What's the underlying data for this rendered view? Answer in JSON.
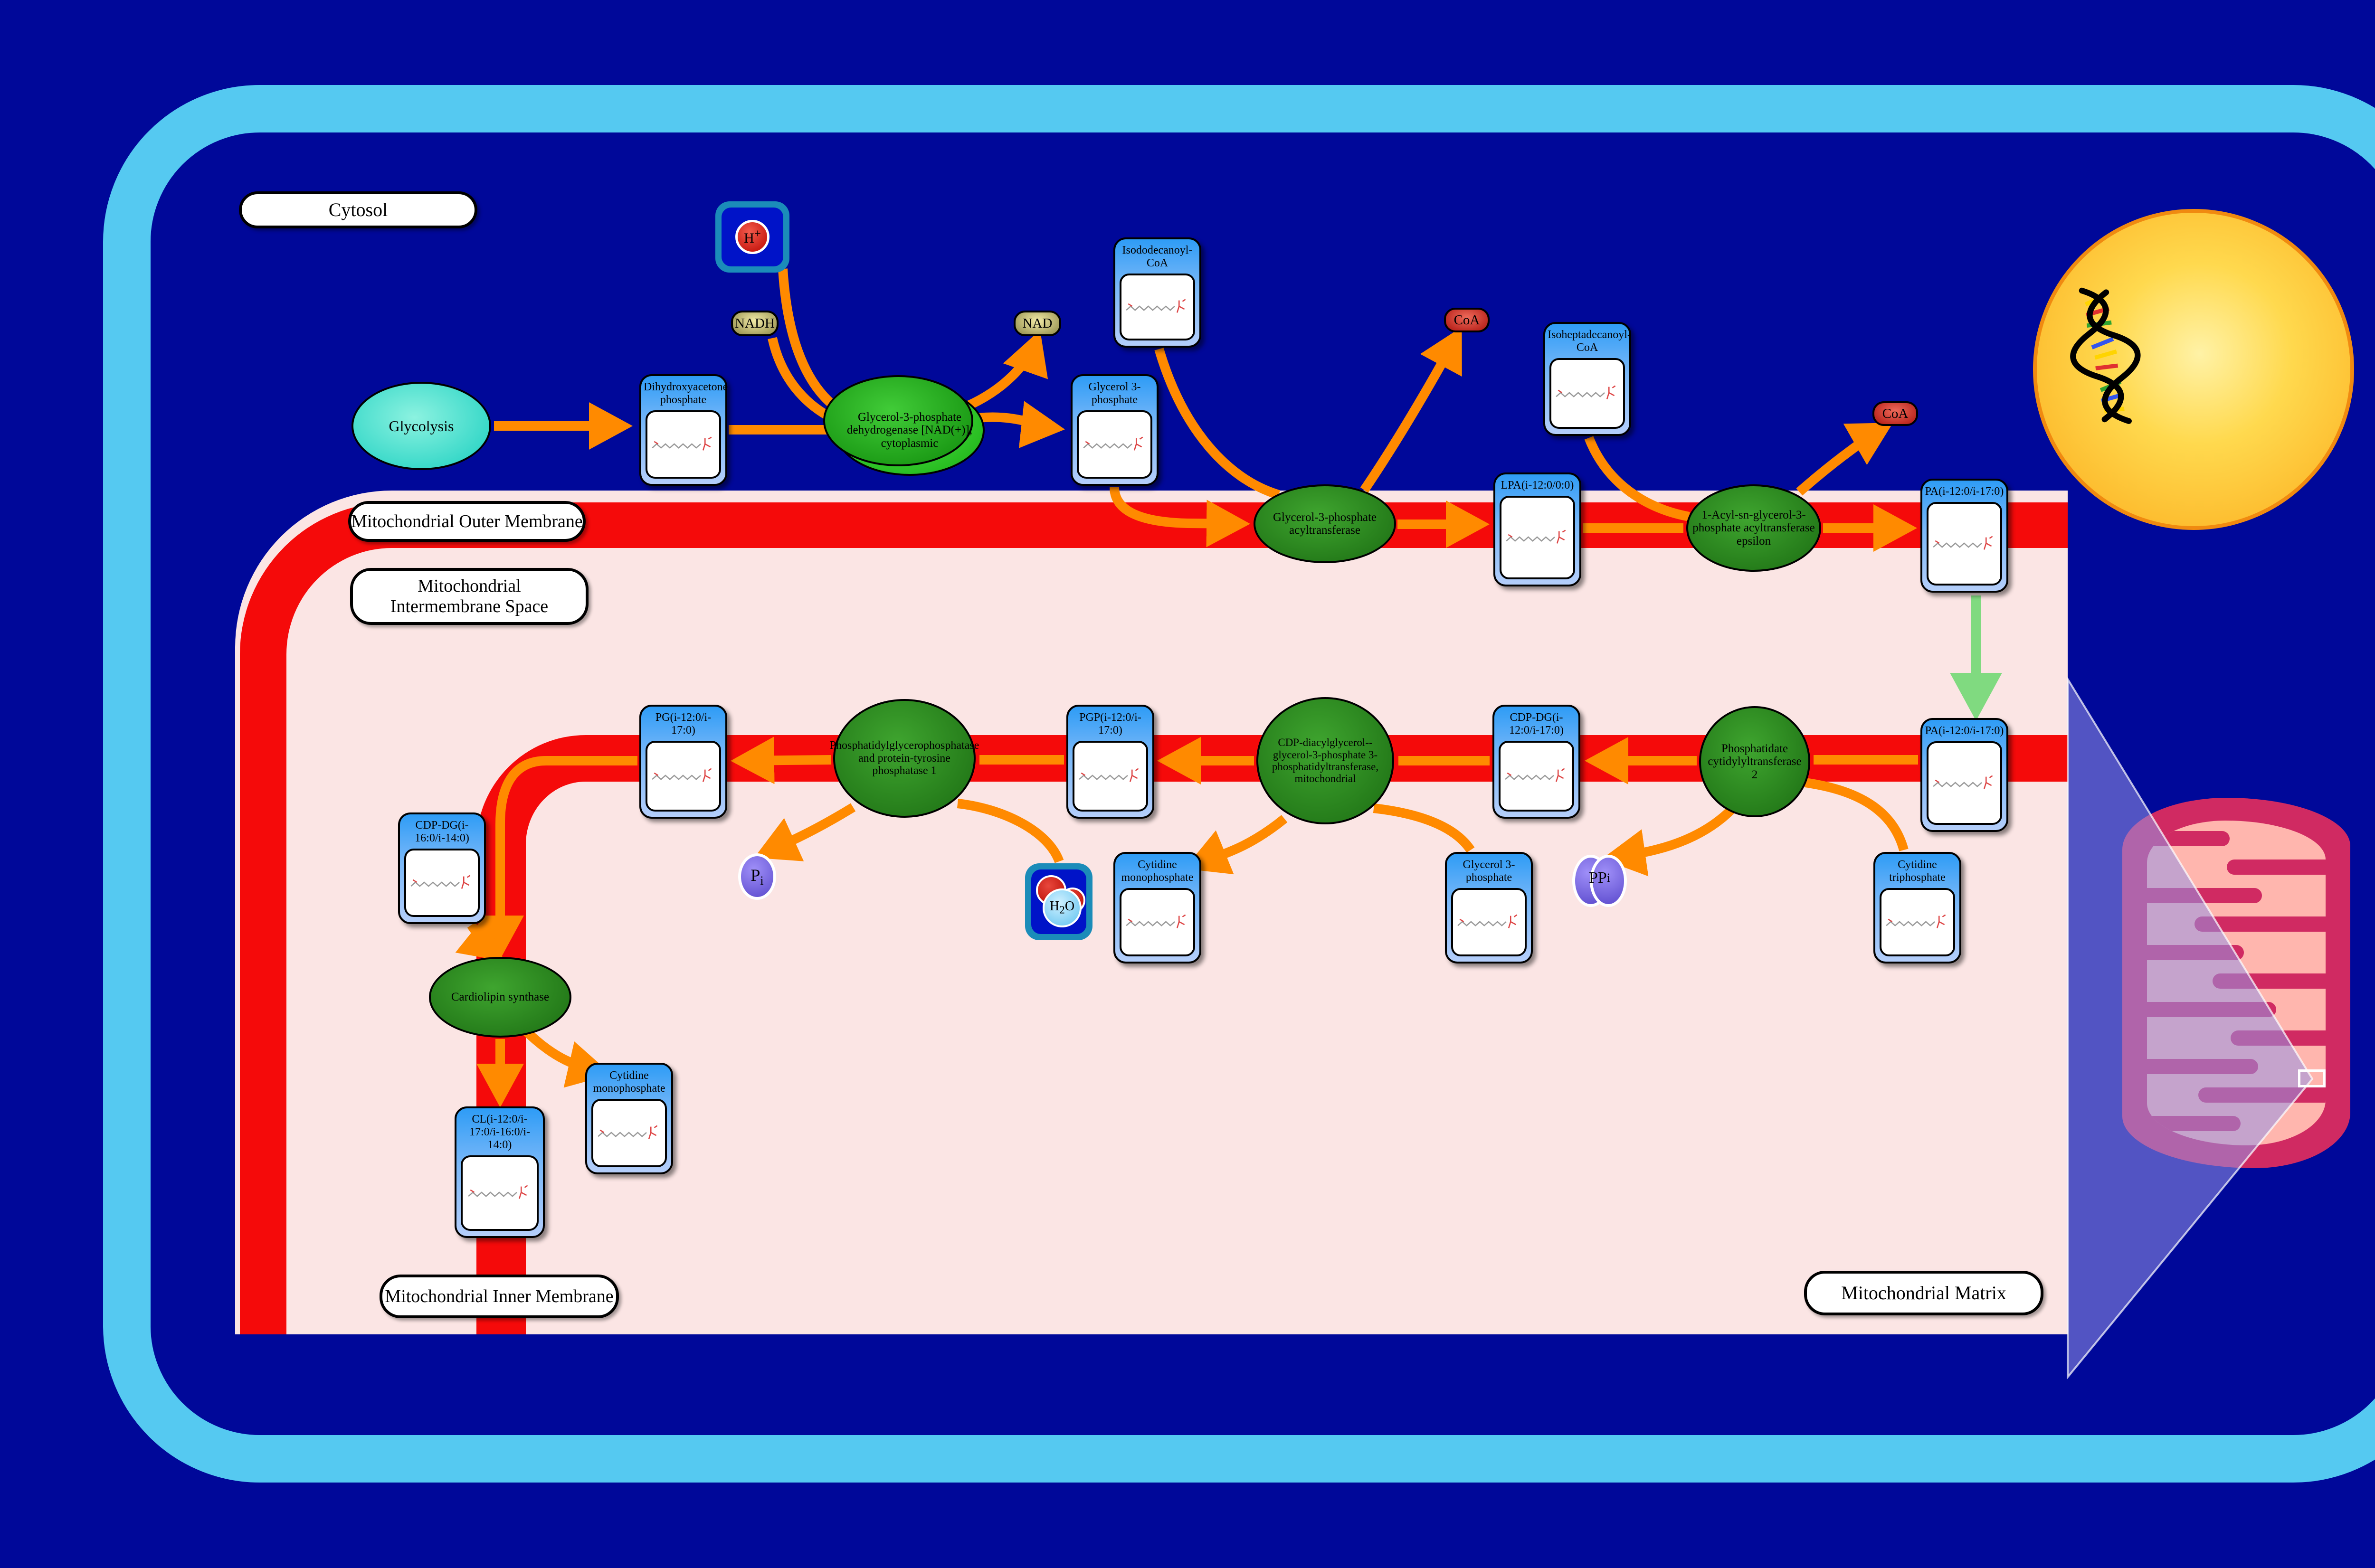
{
  "regions": {
    "cytosol": "Cytosol",
    "outer_membrane": "Mitochondrial Outer Membrane",
    "intermembrane_space": "Mitochondrial Intermembrane Space",
    "inner_membrane": "Mitochondrial Inner Membrane",
    "matrix": "Mitochondrial Matrix"
  },
  "nodes": {
    "glycolysis": {
      "label": "Glycolysis",
      "type": "pathway"
    },
    "dhap": {
      "label": "Dihydroxyacetone phosphate",
      "type": "compound"
    },
    "g3pdh": {
      "label": "Glycerol-3-phosphate dehydrogenase [NAD(+)], cytoplasmic",
      "type": "enzyme"
    },
    "nadh": {
      "label": "NADH",
      "type": "cofactor"
    },
    "nad": {
      "label": "NAD",
      "type": "cofactor"
    },
    "h_ion": {
      "base": "H",
      "sup": "+",
      "type": "ion-icon"
    },
    "g3p_cytosol": {
      "label": "Glycerol 3-phosphate",
      "type": "compound"
    },
    "isododecanoyl_coa": {
      "label": "Isododecanoyl-CoA",
      "type": "compound"
    },
    "gpat": {
      "label": "Glycerol-3-phosphate acyltransferase",
      "type": "enzyme"
    },
    "coa_1": {
      "label": "CoA",
      "type": "cofactor"
    },
    "coa_2": {
      "label": "CoA",
      "type": "cofactor"
    },
    "lpa": {
      "label": "LPA(i-12:0/0:0)",
      "type": "compound"
    },
    "isoheptadecanoyl_coa": {
      "label": "Isoheptadecanoyl-CoA",
      "type": "compound"
    },
    "agpat_epsilon": {
      "label": "1-Acyl-sn-glycerol-3-phosphate acyltransferase epsilon",
      "type": "enzyme"
    },
    "pa_outer": {
      "label": "PA(i-12:0/i-17:0)",
      "type": "compound"
    },
    "pa_inner": {
      "label": "PA(i-12:0/i-17:0)",
      "type": "compound"
    },
    "pct2": {
      "label": "Phosphatidate cytidylyltransferase 2",
      "type": "enzyme"
    },
    "cdp_dg_12_17": {
      "label": "CDP-DG(i-12:0/i-17:0)",
      "type": "compound"
    },
    "cgs_transferase": {
      "label": "CDP-diacylglycerol--glycerol-3-phosphate 3-phosphatidyltransferase, mitochondrial",
      "type": "enzyme"
    },
    "pgp": {
      "label": "PGP(i-12:0/i-17:0)",
      "type": "compound"
    },
    "pgpase": {
      "label": "Phosphatidylglycerophosphatase and protein-tyrosine phosphatase 1",
      "type": "enzyme"
    },
    "pg": {
      "label": "PG(i-12:0/i-17:0)",
      "type": "compound"
    },
    "pi": {
      "base": "P",
      "sub": "i",
      "type": "ion"
    },
    "ppi": {
      "base": "PP",
      "sub": "i",
      "type": "ion"
    },
    "h2o": {
      "h": "H",
      "sub": "2",
      "o": "O",
      "type": "molecule-icon"
    },
    "cmp_1": {
      "label": "Cytidine monophosphate",
      "type": "compound"
    },
    "g3p_matrix": {
      "label": "Glycerol 3-phosphate",
      "type": "compound"
    },
    "ctp": {
      "label": "Cytidine triphosphate",
      "type": "compound"
    },
    "cdp_dg_16_14": {
      "label": "CDP-DG(i-16:0/i-14:0)",
      "type": "compound"
    },
    "cardiolipin_synthase": {
      "label": "Cardiolipin synthase",
      "type": "enzyme"
    },
    "cmp_2": {
      "label": "Cytidine monophosphate",
      "type": "compound"
    },
    "cl": {
      "label": "CL(i-12:0/i-17:0/i-16:0/i-14:0)",
      "type": "compound"
    }
  },
  "colors": {
    "background": "#000899",
    "cell_border": "#55C9F1",
    "membrane_red": "#F50A0A",
    "intermembrane_pink": "#FBE5E4",
    "arrow_orange": "#FF8A00",
    "transport_arrow_green": "#80DA80",
    "enzyme_green_dark": "#1B6C12",
    "enzyme_green_bright": "#16AD10",
    "compound_header_blue": "#2E9CF6",
    "cofactor_khaki": "#8D8848",
    "coa_red": "#AE1510",
    "ion_purple": "#5A49CC",
    "pathway_teal": "#19CFC0",
    "nucleus_yellow": "#FBA919",
    "mitochondrion_crimson": "#D02A62",
    "mitochondrion_pink": "#FFB6AE"
  }
}
